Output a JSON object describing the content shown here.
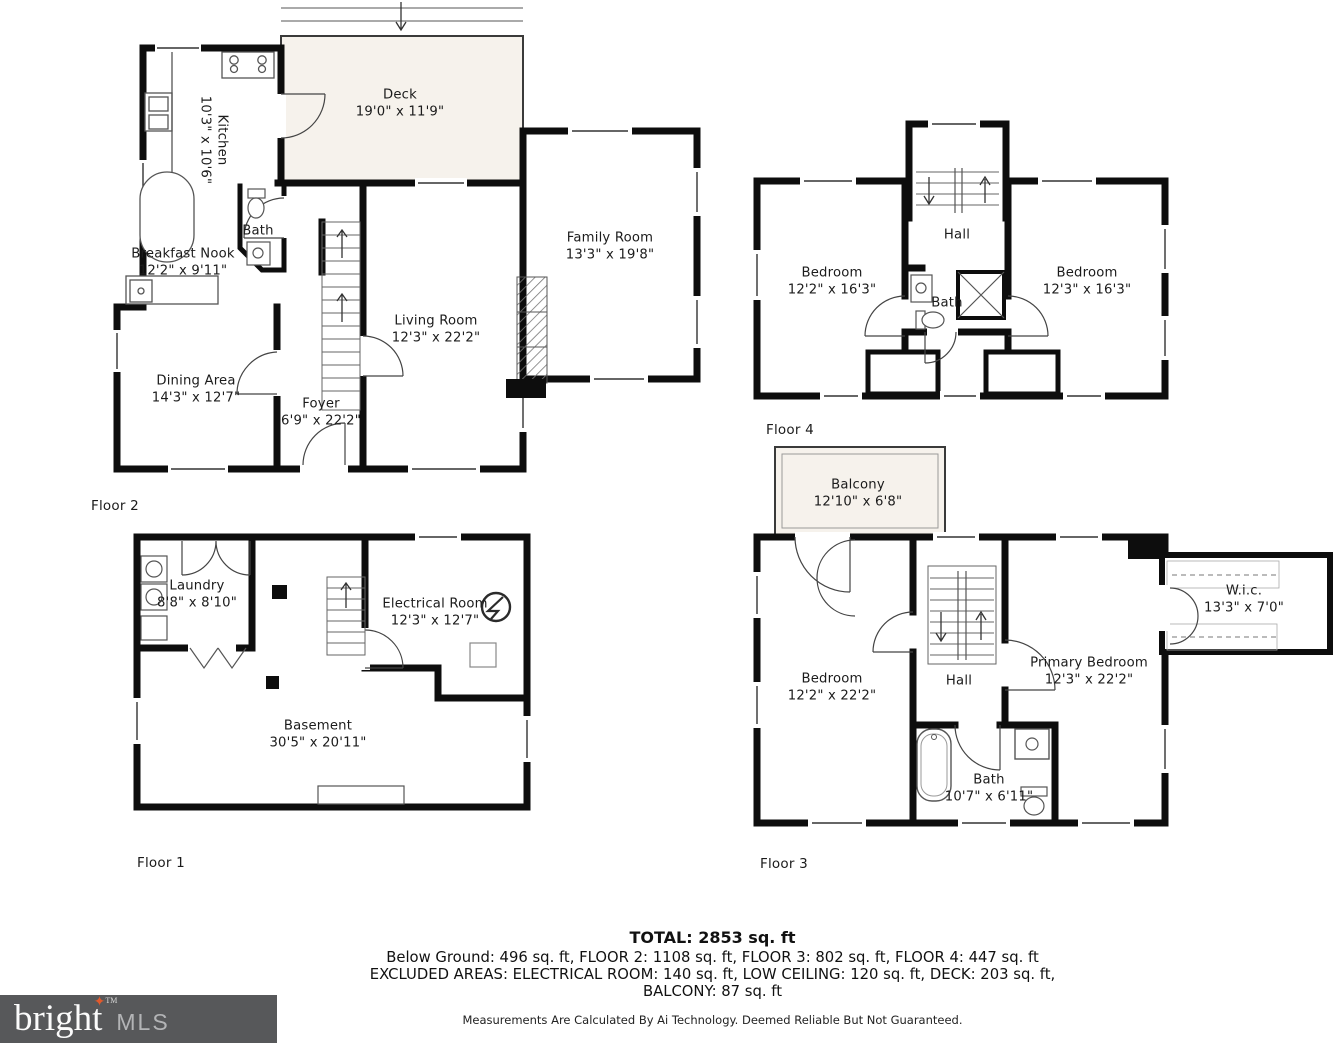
{
  "floors": {
    "floor2": {
      "caption": "Floor 2",
      "rooms": {
        "kitchen": {
          "name": "Kitchen",
          "dims": "10'3\" x 10'6\""
        },
        "deck": {
          "name": "Deck",
          "dims": "19'0\" x 11'9\""
        },
        "bath": {
          "name": "Bath",
          "dims": ""
        },
        "breakfast_nook": {
          "name": "Breakfast Nook",
          "dims": "12'2\" x 9'11\""
        },
        "dining_area": {
          "name": "Dining Area",
          "dims": "14'3\" x 12'7\""
        },
        "foyer": {
          "name": "Foyer",
          "dims": "6'9\" x 22'2\""
        },
        "living_room": {
          "name": "Living Room",
          "dims": "12'3\" x 22'2\""
        },
        "family_room": {
          "name": "Family Room",
          "dims": "13'3\" x 19'8\""
        }
      }
    },
    "floor4": {
      "caption": "Floor 4",
      "rooms": {
        "bedroom_left": {
          "name": "Bedroom",
          "dims": "12'2\" x 16'3\""
        },
        "bedroom_right": {
          "name": "Bedroom",
          "dims": "12'3\" x 16'3\""
        },
        "hall": {
          "name": "Hall",
          "dims": ""
        },
        "bath": {
          "name": "Bath",
          "dims": ""
        }
      }
    },
    "floor1": {
      "caption": "Floor 1",
      "rooms": {
        "laundry": {
          "name": "Laundry",
          "dims": "8'8\" x 8'10\""
        },
        "electrical_room": {
          "name": "Electrical Room",
          "dims": "12'3\" x 12'7\""
        },
        "basement": {
          "name": "Basement",
          "dims": "30'5\" x 20'11\""
        }
      }
    },
    "floor3": {
      "caption": "Floor 3",
      "rooms": {
        "balcony": {
          "name": "Balcony",
          "dims": "12'10\" x 6'8\""
        },
        "bedroom": {
          "name": "Bedroom",
          "dims": "12'2\" x 22'2\""
        },
        "hall": {
          "name": "Hall",
          "dims": ""
        },
        "primary_bedroom": {
          "name": "Primary Bedroom",
          "dims": "12'3\" x 22'2\""
        },
        "wic": {
          "name": "W.i.c.",
          "dims": "13'3\" x 7'0\""
        },
        "bath": {
          "name": "Bath",
          "dims": "10'7\" x 6'11\""
        }
      }
    }
  },
  "summary": {
    "total": "TOTAL: 2853 sq. ft",
    "line1": "Below Ground: 496 sq. ft, FLOOR 2: 1108 sq. ft, FLOOR 3: 802 sq. ft, FLOOR 4: 447 sq. ft",
    "line2": "EXCLUDED AREAS: ELECTRICAL ROOM: 140 sq. ft, LOW CEILING: 120 sq. ft, DECK: 203 sq. ft,",
    "line3": "BALCONY: 87 sq. ft",
    "disclaimer": "Measurements Are Calculated By Ai Technology. Deemed Reliable But Not Guaranteed."
  },
  "logo": {
    "brand": "bright",
    "mls": "MLS",
    "tm": "TM",
    "star_glyph": "✦"
  },
  "colors": {
    "wall": "#0d0d0d",
    "outdoor_fill": "#f6f2ec",
    "logo_bg": "#57585a",
    "logo_star": "#e2592c",
    "logo_mls": "#b3b4b6"
  }
}
